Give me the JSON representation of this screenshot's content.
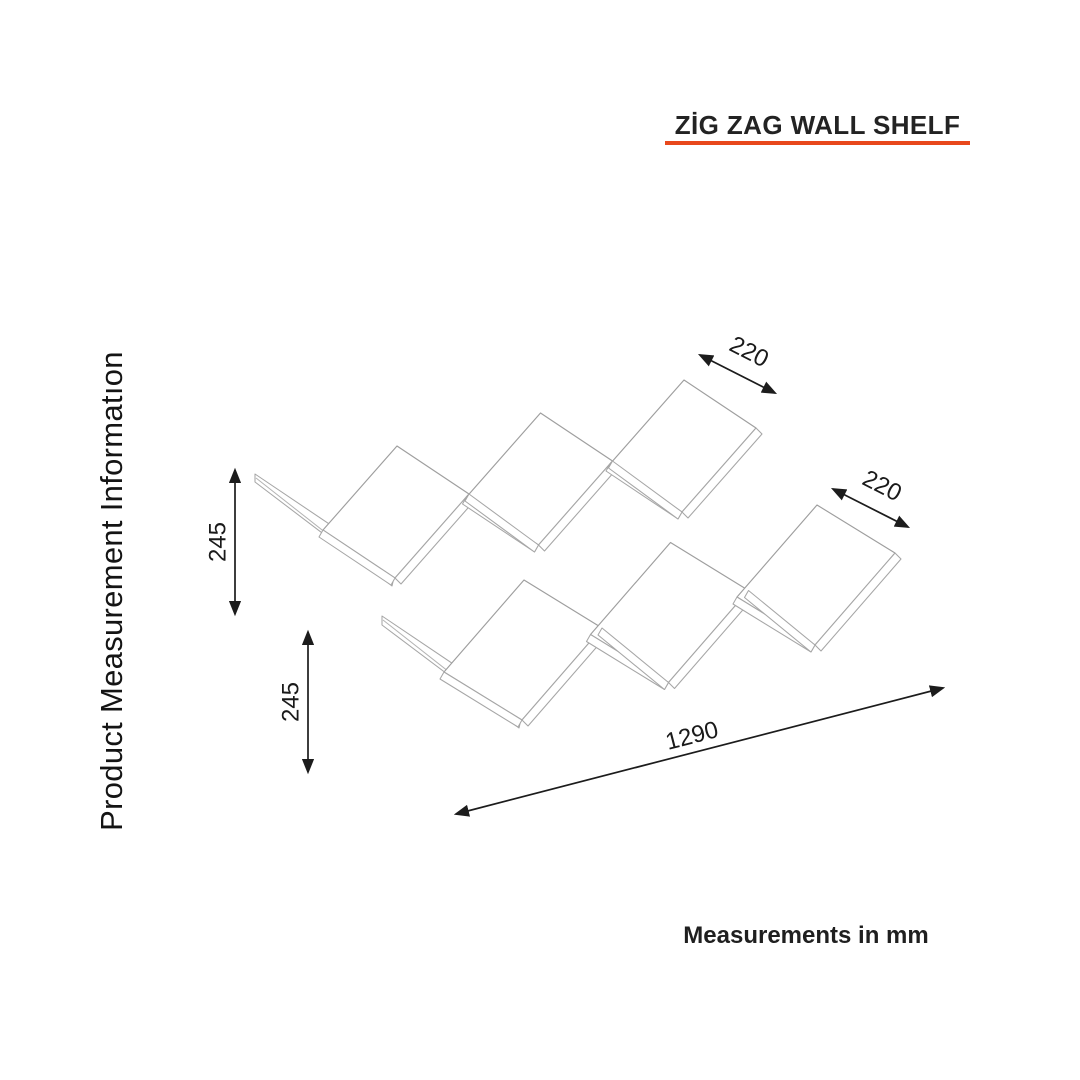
{
  "page": {
    "background_color": "#ffffff"
  },
  "header": {
    "title": "ZİG ZAG WALL SHELF",
    "underline_color": "#e8481c"
  },
  "sidebar": {
    "label": "Product Measurement Informatıon"
  },
  "footer": {
    "note": "Measurements in mm"
  },
  "dimensions": {
    "unit": "mm",
    "depth_top": "220",
    "depth_right": "220",
    "height_upper": "245",
    "height_lower": "245",
    "length": "1290"
  },
  "drawing": {
    "subject": "zig zag wall shelf, isometric line drawing",
    "rows": 2,
    "panels_per_row": 3,
    "line_color": "#9e9e9e",
    "dimension_color": "#1c1c1c"
  }
}
